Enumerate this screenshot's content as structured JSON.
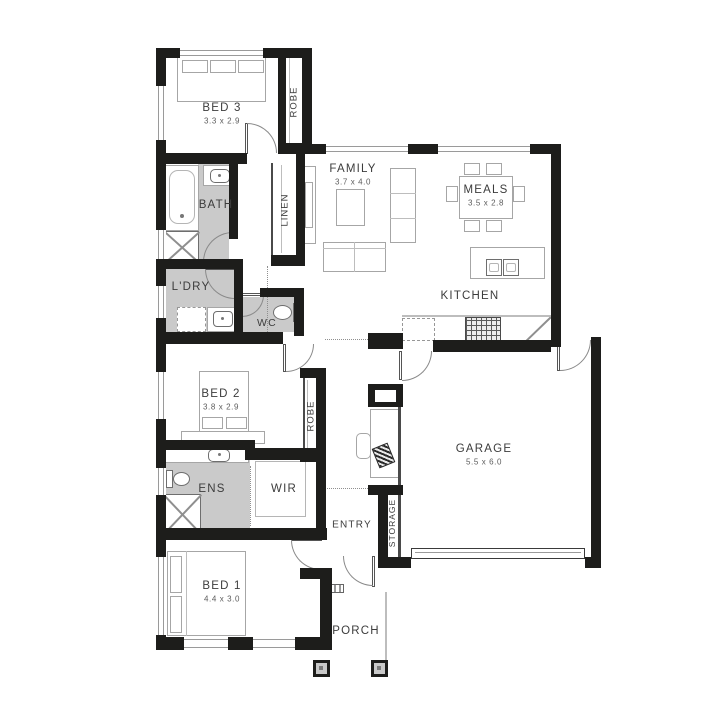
{
  "meta": {
    "type": "floor-plan"
  },
  "colors": {
    "wall": "#1d1d1b",
    "wet_area": "#cacaca",
    "furniture_line": "#a6a6a6",
    "label": "#3c3c3c"
  },
  "rooms": {
    "bed3": {
      "name": "BED 3",
      "dims": "3.3 x 2.9"
    },
    "robe_bed3": {
      "name": "ROBE"
    },
    "bath": {
      "name": "BATH"
    },
    "linen": {
      "name": "LINEN"
    },
    "family": {
      "name": "FAMILY",
      "dims": "3.7 x 4.0"
    },
    "meals": {
      "name": "MEALS",
      "dims": "3.5 x 2.8"
    },
    "kitchen": {
      "name": "KITCHEN"
    },
    "ldry": {
      "name": "L'DRY"
    },
    "wc": {
      "name": "WC"
    },
    "bed2": {
      "name": "BED 2",
      "dims": "3.8 x 2.9"
    },
    "robe_bed2": {
      "name": "ROBE"
    },
    "garage": {
      "name": "GARAGE",
      "dims": "5.5 x 6.0"
    },
    "ens": {
      "name": "ENS"
    },
    "wir": {
      "name": "WIR"
    },
    "entry": {
      "name": "ENTRY"
    },
    "storage": {
      "name": "STORAGE"
    },
    "bed1": {
      "name": "BED 1",
      "dims": "4.4 x 3.0"
    },
    "porch": {
      "name": "PORCH"
    }
  }
}
